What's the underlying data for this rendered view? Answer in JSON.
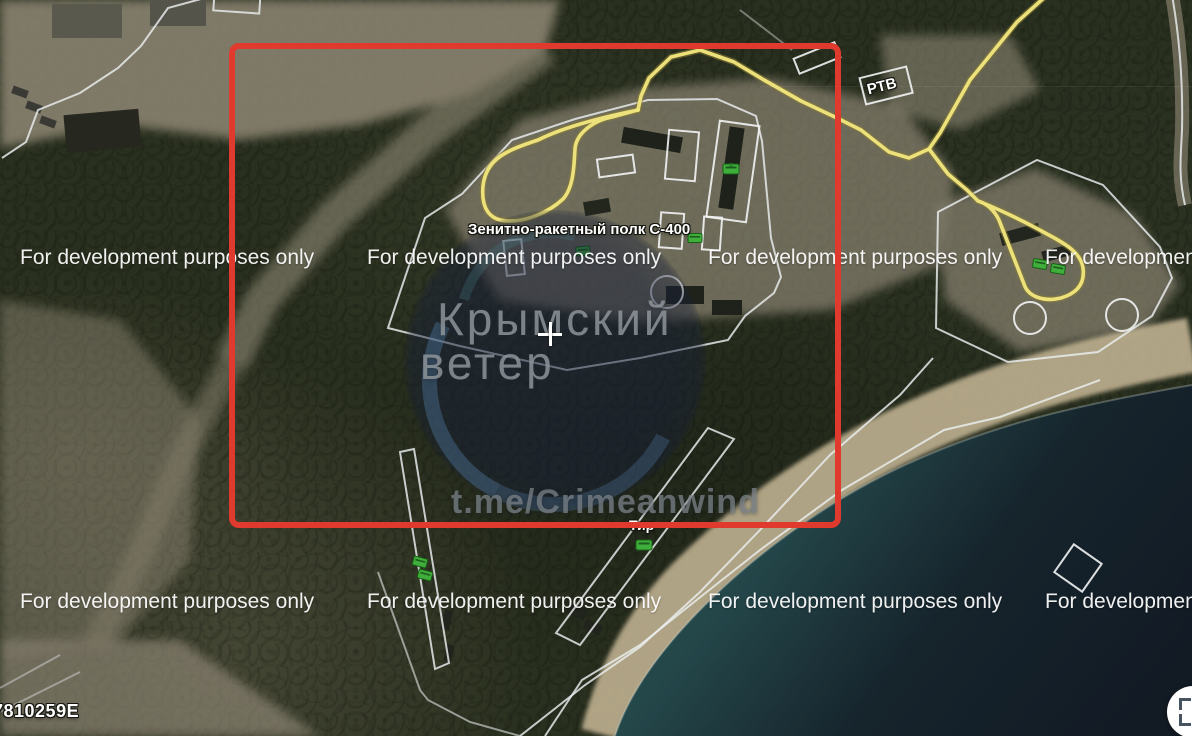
{
  "watermark": {
    "text": "For development purposes only"
  },
  "labels": {
    "s400_site": "Зенитно-ракетный полк С-400",
    "rtv": "РТВ",
    "shooting_range": "Тир"
  },
  "channel_overlay": {
    "name_line1": "Крымский",
    "name_line2": "ветер",
    "url": "t.me/Crimeanwind"
  },
  "status_bar": {
    "coordinates_partial": "7810259E"
  },
  "icons": {
    "bottom_right_control": "expand-arrows-icon"
  },
  "colors": {
    "annotation-red": "#e03a2e",
    "route-yellow": "#f2e87e",
    "route-yellow-halo": "#8a7d35",
    "boundary-white": "#eceff0",
    "marker-white": "#f2f4f4",
    "military-green": "#3fae3b",
    "military-green-dark": "#176117",
    "terrain-tan": "#8f8775",
    "beach-sand": "#c3b494",
    "sea-shallow": "#24474a",
    "sea-deep": "#121a24",
    "forest-dark": "#262c1f",
    "watermark-gray": "#8b9096"
  }
}
